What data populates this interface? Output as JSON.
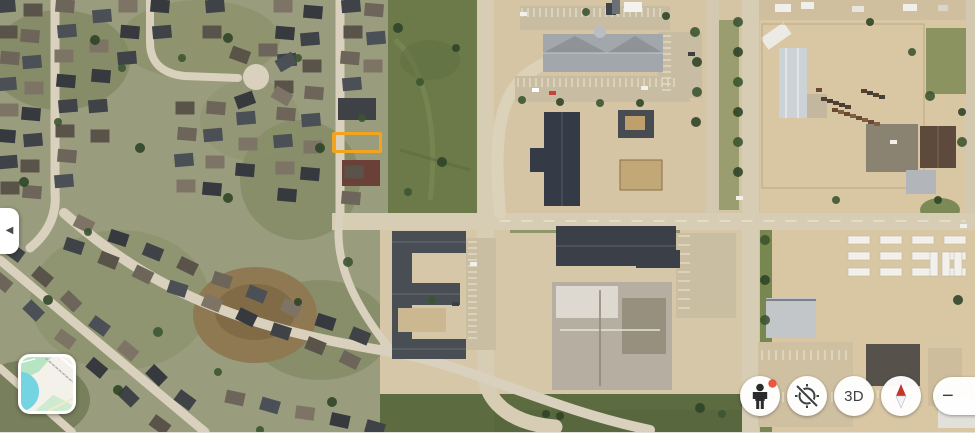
{
  "map": {
    "kind": "satellite-imagery",
    "highlight_box": {
      "color": "#F2A41E"
    }
  },
  "side_panel_toggle": {
    "icon": "chevron-left-icon",
    "glyph": "◀"
  },
  "minimap": {
    "land_color": "#F4F1EA",
    "water_color": "#74D4E2",
    "park_color": "#B7E4C3"
  },
  "controls": {
    "street_view": {
      "icon": "pegman-icon",
      "badge_color": "#E8573F"
    },
    "my_location": {
      "icon": "location-disabled-icon"
    },
    "three_d": {
      "label": "3D"
    },
    "compass": {
      "icon": "compass-needle-icon",
      "north_color": "#C5352B",
      "south_color": "#F1F3F4"
    },
    "zoom_out": {
      "label": "−"
    }
  }
}
